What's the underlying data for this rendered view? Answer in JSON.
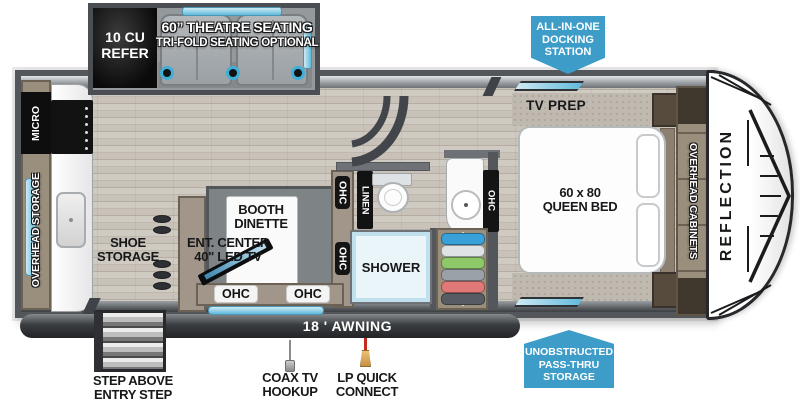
{
  "colors": {
    "badge_blue": "#3D9DC8",
    "window_blue": "#6EC2E0",
    "wood_cabinet": "#9A8E7D",
    "wall_gray": "#53575B",
    "floor_tan": "#C8C2B9",
    "appliance_black": "#121212",
    "seat_gray": "#9AA0A4",
    "shower_blue": "#E9F5F9",
    "cap_white": "#FFFFFF"
  },
  "slideout": {
    "refer_label": "10 CU REFER",
    "theatre_line1": "60” THEATRE SEATING",
    "theatre_line2": "TRI-FOLD SEATING OPTIONAL"
  },
  "badges": {
    "docking_line1": "ALL-IN-ONE",
    "docking_line2": "DOCKING",
    "docking_line3": "STATION",
    "passthru_line1": "UNOBSTRUCTED",
    "passthru_line2": "PASS-THRU",
    "passthru_line3": "STORAGE"
  },
  "kitchen": {
    "micro": "MICRO",
    "overhead_storage": "OVERHEAD STORAGE",
    "shoe_line1": "SHOE",
    "shoe_line2": "STORAGE"
  },
  "living": {
    "ent_line1": "ENT. CENTER",
    "ent_line2": "40\" LED TV",
    "dinette_line1": "BOOTH",
    "dinette_line2": "DINETTE",
    "ohc": "OHC"
  },
  "bath": {
    "linen": "LINEN",
    "shower": "SHOWER",
    "ohc": "OHC"
  },
  "bedroom": {
    "tv_prep": "TV PREP",
    "bed_line1": "60 x 80",
    "bed_line2": "QUEEN BED",
    "overhead_cabinets": "OVERHEAD CABINETS"
  },
  "brand": {
    "model": "REFLECTION"
  },
  "exterior": {
    "awning": "18 ' AWNING",
    "step_line1": "STEP ABOVE",
    "step_line2": "ENTRY STEP",
    "coax_line1": "COAX TV",
    "coax_line2": "HOOKUP",
    "lp_line1": "LP QUICK",
    "lp_line2": "CONNECT"
  }
}
